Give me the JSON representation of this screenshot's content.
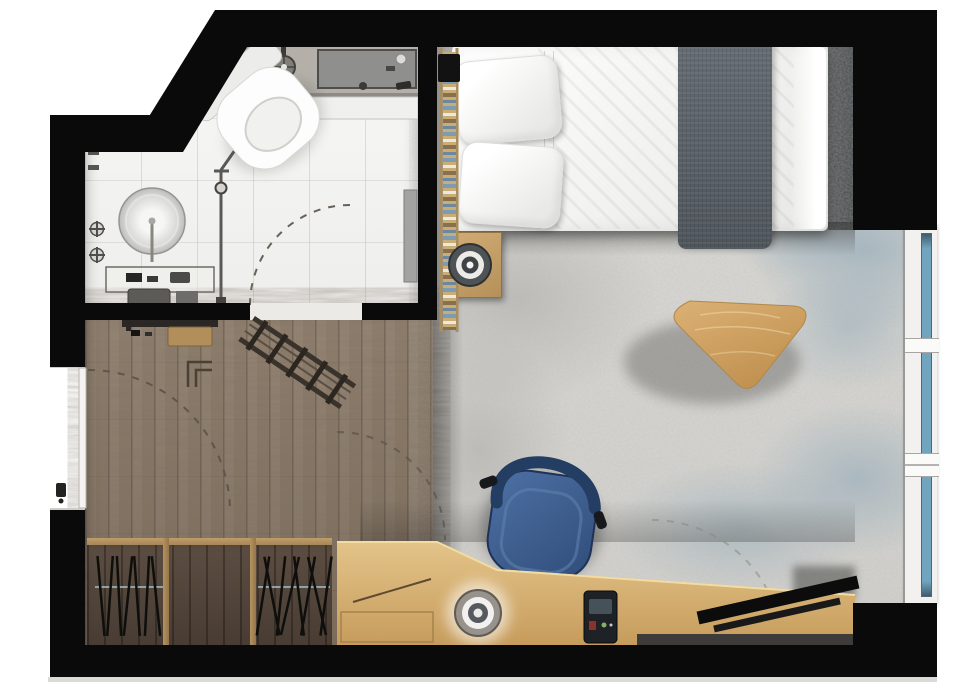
{
  "meta": {
    "title": "Studio apartment floor plan",
    "view": "top-down architectural rendering",
    "canvas_width": 970,
    "canvas_height": 700
  },
  "rooms": [
    {
      "id": "bathroom",
      "label": "Bathroom",
      "floor": "white large-format tile",
      "items": [
        "corner toilet",
        "walk-in shower",
        "shower shelf",
        "shower head",
        "round washbasin",
        "twin cross faucet handles",
        "vanity counter with toiletries",
        "vertical pipe rail",
        "wall panel mirror",
        "inward-swinging door (dashed arc)",
        "sloped-ceiling dashed line"
      ]
    },
    {
      "id": "hallway",
      "label": "Entry hall",
      "floor": "dark oak plank wood",
      "items": [
        "entry door with handle",
        "door swing arcs",
        "wall bench",
        "wooden stool",
        "folding luggage rack",
        "wall hook outline",
        "open wardrobe hanger section left",
        "open wardrobe shelf section",
        "open wardrobe hanger section right"
      ]
    },
    {
      "id": "bedroom",
      "label": "Bedroom / living area",
      "floor": "mottled grey rug with blue wash",
      "items": [
        "double bed with white duvet",
        "two pillows",
        "grey throw runner",
        "wooden ladder rack",
        "bedside table",
        "round speaker",
        "pebble-shaped coffee table",
        "blue desk chair",
        "built-in angled desk",
        "desk speaker",
        "phone dock",
        "flat TV on desk",
        "media shelf",
        "window wall with three panes"
      ]
    }
  ],
  "labels": {
    "plan": "Studio apartment floor plan",
    "bathroom": "Bathroom",
    "hallway": "Entry hall",
    "bedroom": "Bedroom / living area",
    "toilet": "Toilet",
    "shower": "Walk-in shower",
    "shower_shelf": "Shower shelf",
    "shower_head": "Shower head",
    "washbasin": "Round washbasin",
    "vanity": "Vanity counter",
    "mirror": "Wall panel",
    "pipe": "Pipe rail",
    "bath_door_arc": "Bathroom door swing",
    "entry_door": "Entry door",
    "entry_arc": "Entry door swing",
    "bench": "Wall bench",
    "stool": "Wooden stool",
    "luggage_rack": "Folding luggage rack",
    "wardrobe": "Open wardrobe",
    "hanger": "Clothes hanger",
    "bed": "Double bed",
    "pillow": "Pillow",
    "throw": "Grey throw runner",
    "ladder": "Ladder rack",
    "nightstand": "Bedside table",
    "speaker": "Round speaker",
    "coffee_table": "Pebble coffee table",
    "chair": "Desk chair",
    "desk": "Built-in desk",
    "desk_speaker": "Desk speaker",
    "dock": "Phone dock",
    "tv": "Flat TV",
    "media_shelf": "Media shelf",
    "window": "Window wall",
    "rug": "Area rug",
    "hall_floor": "Wood plank floor",
    "bath_floor": "Tiled floor",
    "walls": "Walls"
  },
  "palette": {
    "wall": "#0a0a0a",
    "bath_tile": "#f4f4f2",
    "shower_floor": "#b4b0a9",
    "hall_wood": "#85735f",
    "rug_base": "#d8d7d3",
    "rug_blue": "#769ab2",
    "bed_white": "#f7f7f5",
    "throw_grey": "#596066",
    "wood_light": "#d8b578",
    "wood_mid": "#b6905a",
    "chair_blue": "#3e5d8e",
    "glass_blue": "#71a4bf",
    "tv_black": "#0c0c0c"
  },
  "windows": {
    "pane_count": 3,
    "glass_color": "#71a4bf"
  }
}
